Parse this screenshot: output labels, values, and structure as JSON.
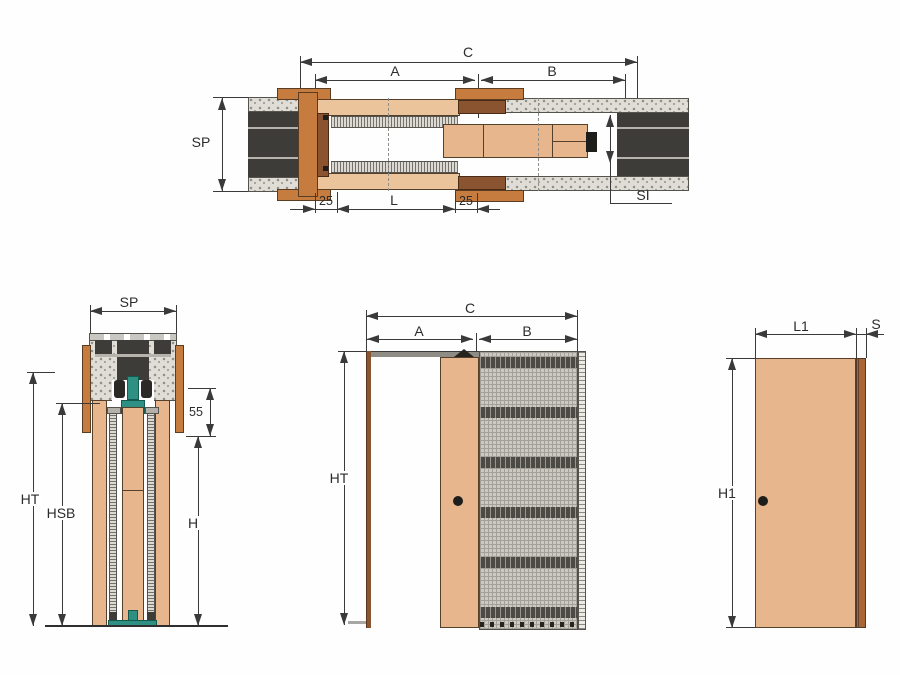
{
  "document": {
    "type": "technical-drawing",
    "subject": "pocket sliding door system sections"
  },
  "colors": {
    "door_tan": "#e7b68d",
    "frame_orange": "#c67c3e",
    "edge_brown": "#a86538",
    "wall_dark": "#3d3c39",
    "plaster_stipple": "#dfddd5",
    "mesh_grid": "#ccc9c2",
    "hardware_teal": "#2e9082",
    "dimension_line": "#3a3a3a"
  },
  "views": {
    "plan": {
      "label_c": "C",
      "label_a": "A",
      "label_b": "B",
      "label_sp": "SP",
      "label_si": "SI",
      "label_offset_left": "25",
      "label_l": "L",
      "label_offset_right": "25"
    },
    "section": {
      "label_sp": "SP",
      "label_55": "55",
      "label_ht": "HT",
      "label_hsb": "HSB",
      "label_h": "H"
    },
    "elevation": {
      "label_c": "C",
      "label_a": "A",
      "label_b": "B",
      "label_ht": "HT"
    },
    "panel": {
      "label_l1": "L1",
      "label_s": "S",
      "label_h1": "H1"
    }
  }
}
